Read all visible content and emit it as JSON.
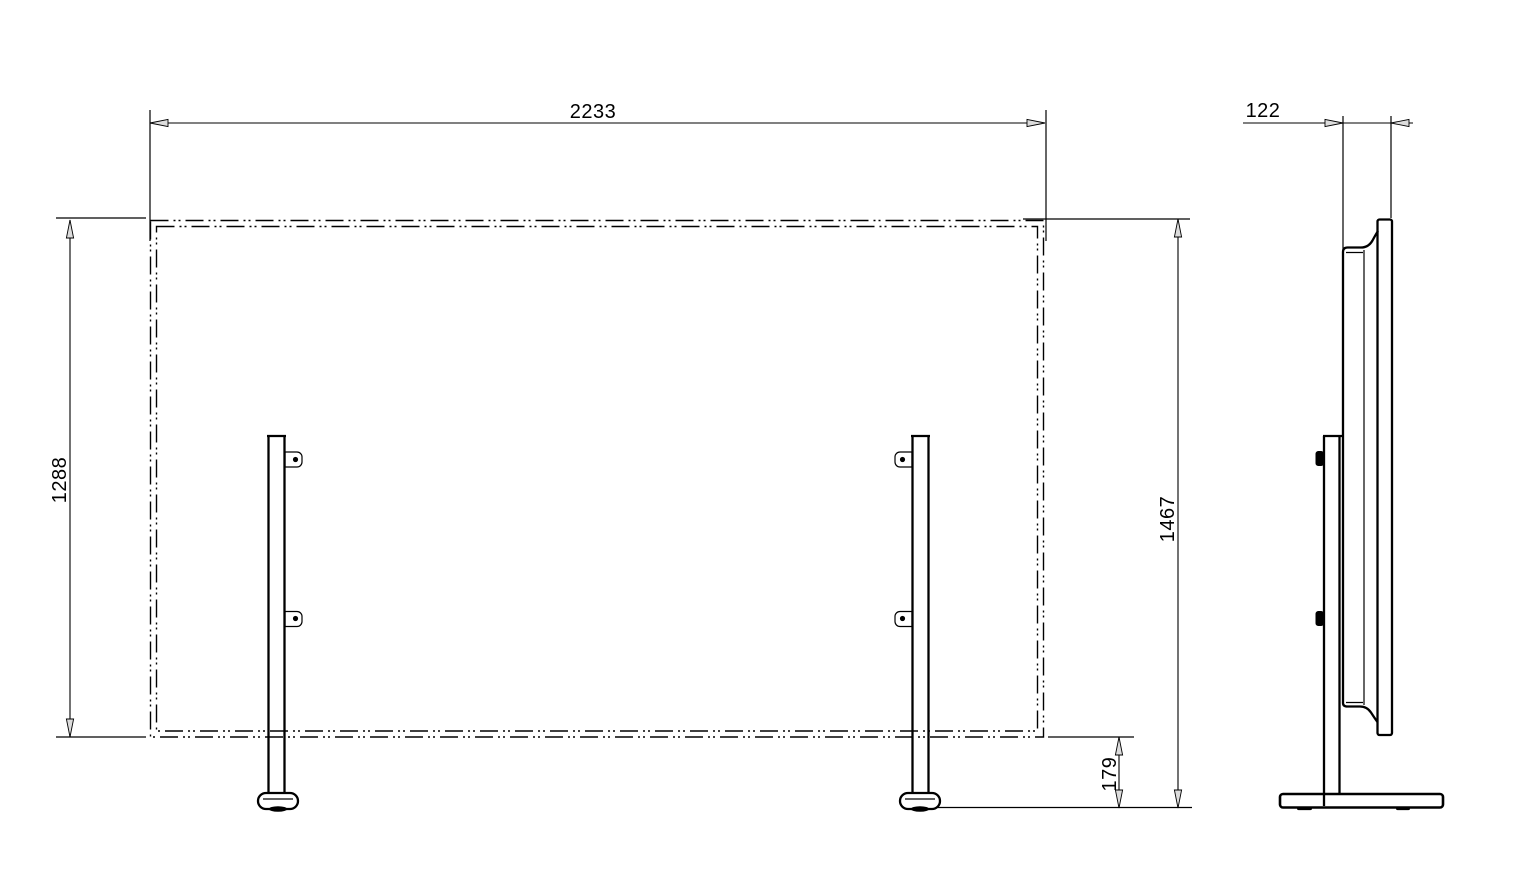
{
  "colors": {
    "background": "#ffffff",
    "line": "#000000"
  },
  "front_view": {
    "dim_width": "2233",
    "dim_screen_height": "1288",
    "dim_total_height": "1467",
    "dim_ground_clearance": "179"
  },
  "side_view": {
    "dim_depth": "122"
  }
}
